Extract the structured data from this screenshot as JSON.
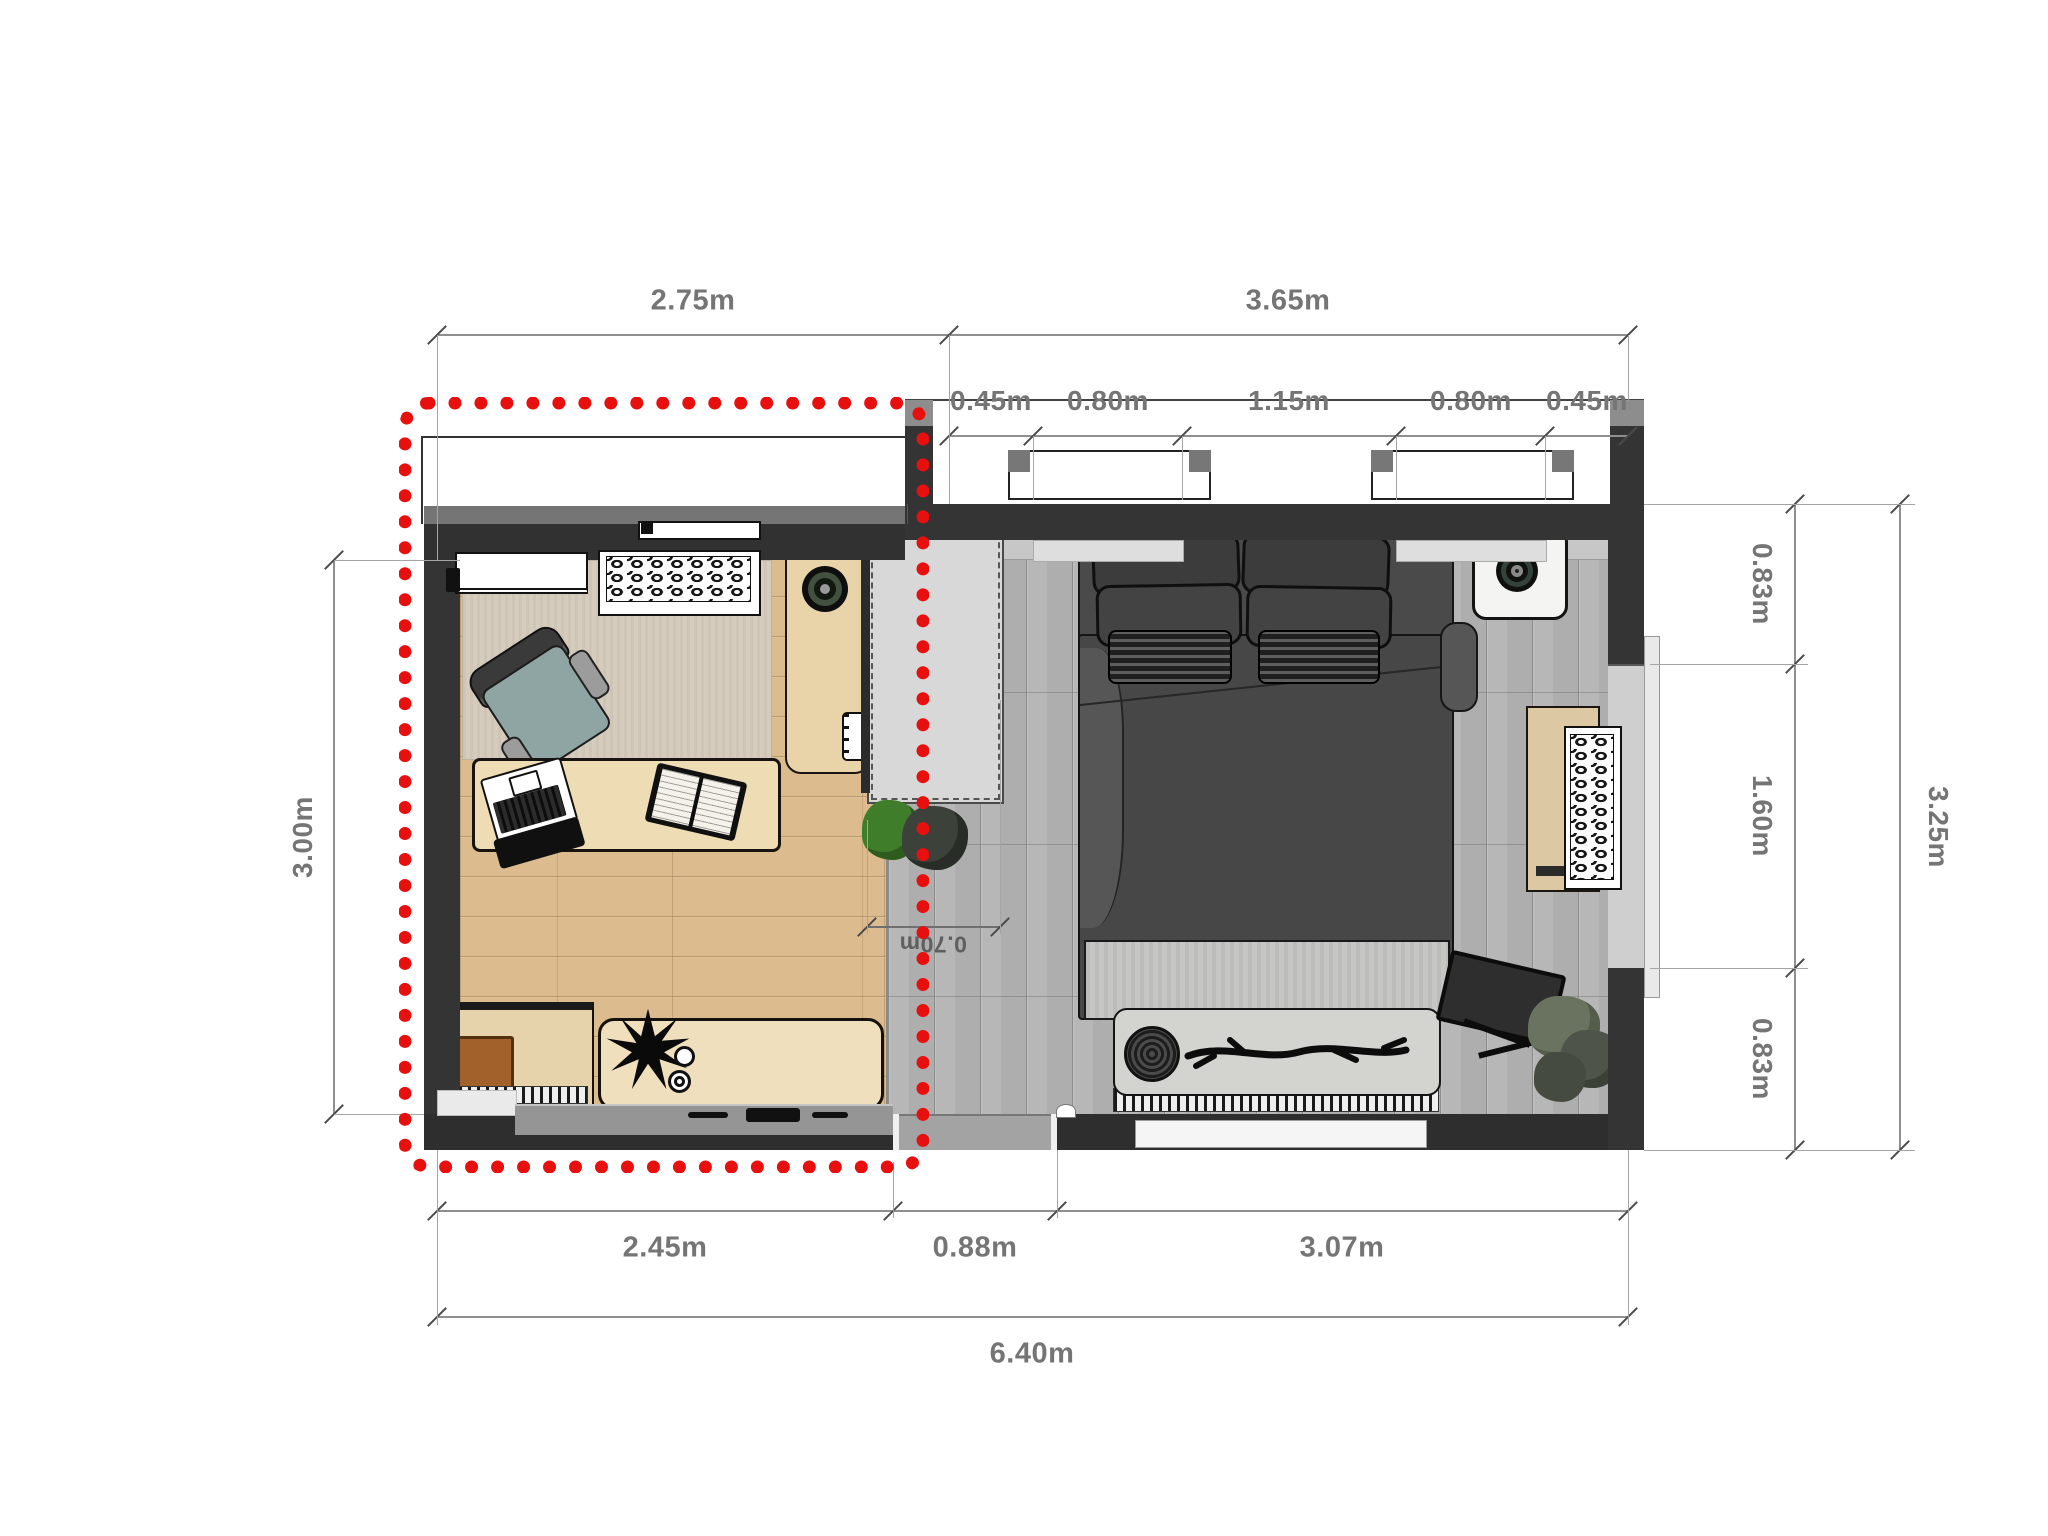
{
  "drawing": {
    "type": "apartment floor plan, top view",
    "highlight": "red dotted rectangle around living-room zone"
  },
  "dimensions": {
    "top_left": "2.75m",
    "top_right_total": "3.65m",
    "top_sub": [
      "0.45m",
      "0.80m",
      "1.15m",
      "0.80m",
      "0.45m"
    ],
    "left_height": "3.00m",
    "right_segments": [
      "0.83m",
      "1.60m",
      "0.83m"
    ],
    "right_total": "3.25m",
    "bottom_segments": [
      "2.45m",
      "0.88m",
      "3.07m"
    ],
    "bottom_total": "6.40m",
    "closet_depth": "0.70m"
  },
  "rooms": {
    "left": "living room with wood floor",
    "right": "bedroom with gray plank floor",
    "middle": "wardrobe / entry passage"
  },
  "furniture": [
    "wall-ac-unit",
    "rattan-console",
    "area-rug",
    "armchair",
    "coffee-table",
    "laptop",
    "open-book",
    "desk",
    "round-speaker",
    "spiral-notebook",
    "low-cabinet",
    "wood-tray",
    "sideboard",
    "plant-decor",
    "cups",
    "wardrobe",
    "entry-plants",
    "double-bed",
    "pillows",
    "woven-baskets",
    "duvet",
    "foot-bench",
    "woven-disc",
    "branch-decor",
    "radiator",
    "nightstand",
    "speaker-lamp",
    "dresser-rattan",
    "tv-on-stand",
    "corner-plant",
    "entrance-door"
  ],
  "colors": {
    "highlight_red": "#e80f0f",
    "wall_dark": "#343434",
    "wood_floor": "#dcbc8e",
    "gray_floor": "#b7b7b7",
    "armchair_teal": "#8fa5a3",
    "dim_text": "#757575"
  }
}
